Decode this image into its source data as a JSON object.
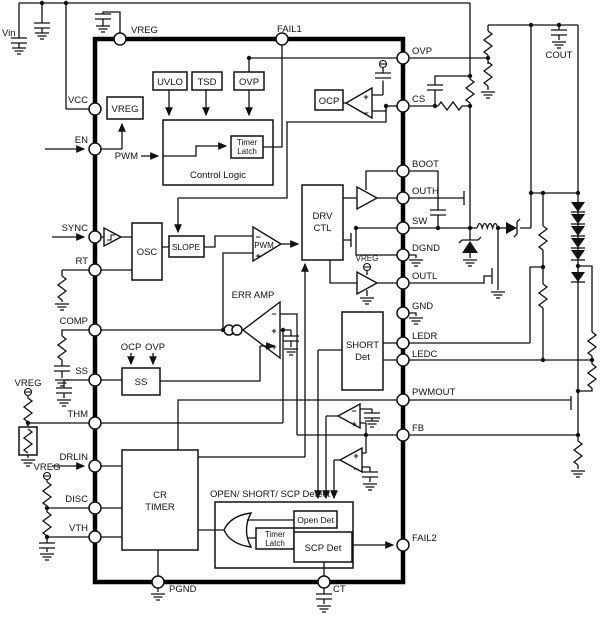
{
  "title": "IC block diagram",
  "pins": {
    "vin": "Vin",
    "vreg_top": "VREG",
    "fail1": "FAIL1",
    "vcc": "VCC",
    "en": "EN",
    "sync": "SYNC",
    "rt": "RT",
    "comp": "COMP",
    "ss": "SS",
    "thm": "THM",
    "drlin": "DRLIN",
    "disc": "DISC",
    "vth": "VTH",
    "ovp": "OVP",
    "cs": "CS",
    "boot": "BOOT",
    "outh": "OUTH",
    "sw": "SW",
    "dgnd": "DGND",
    "outl": "OUTL",
    "gnd": "GND",
    "ledr": "LEDR",
    "ledc": "LEDC",
    "pwmout": "PWMOUT",
    "fb": "FB",
    "fail2": "FAIL2",
    "pgnd": "PGND",
    "ct": "CT",
    "cout": "COUT"
  },
  "blocks": {
    "vreg": "VREG",
    "uvlo": "UVLO",
    "tsd": "TSD",
    "ovp": "OVP",
    "control_logic": "Control Logic",
    "timer": "Timer",
    "latch": "Latch",
    "osc": "OSC",
    "slope": "SLOPE",
    "pwm": "PWM",
    "drv1": "DRV",
    "drv2": "CTL",
    "err_amp": "ERR AMP",
    "ss": "SS",
    "short1": "SHORT",
    "short2": "Det",
    "cr1": "CR",
    "cr2": "TIMER",
    "ocp": "OCP",
    "detect_title": "OPEN/ SHORT/ SCP Detect",
    "open_det": "Open Det",
    "scp_det": "SCP Det"
  },
  "signals": {
    "pwm_in": "PWM",
    "ocp": "OCP",
    "ovp": "OVP",
    "vreg": "VREG",
    "plus": "+",
    "minus": "−"
  }
}
